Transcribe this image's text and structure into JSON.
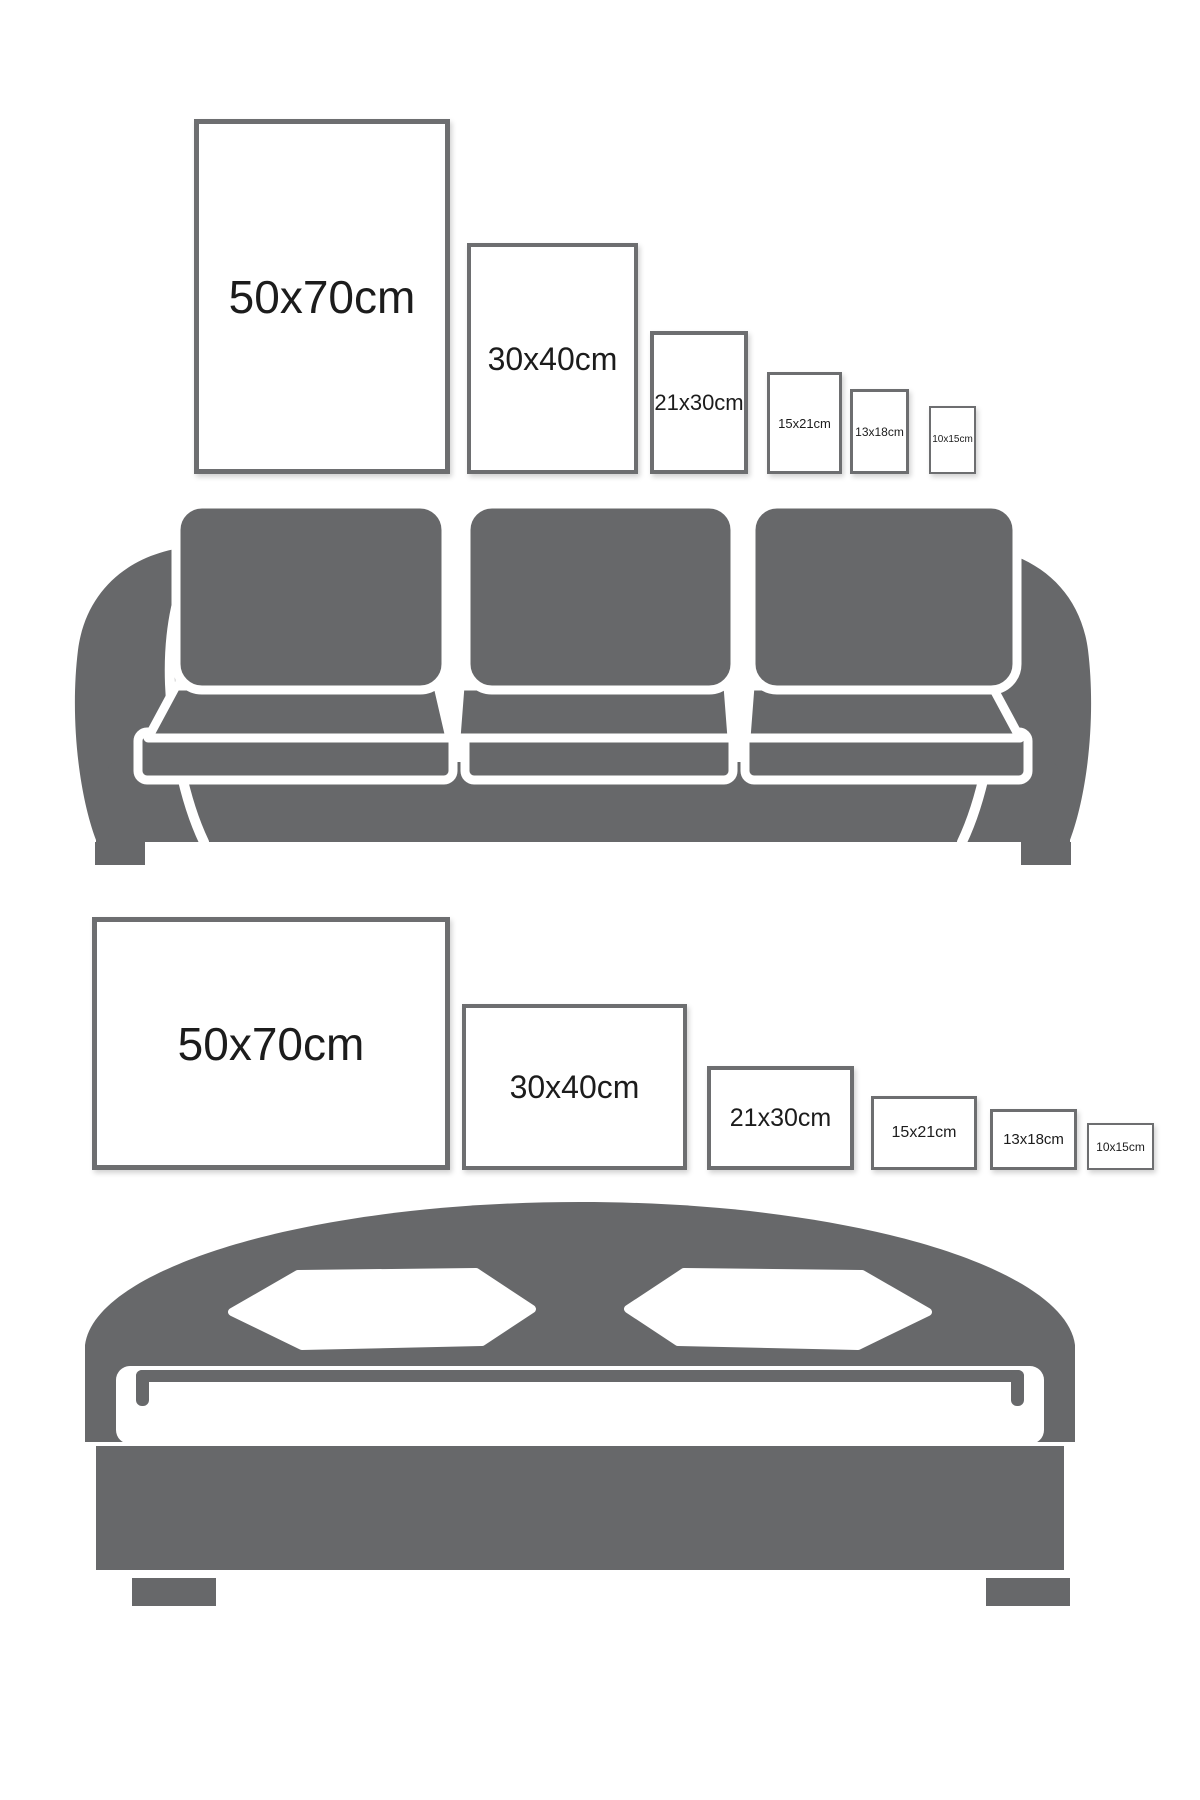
{
  "diagram": {
    "description": "Picture frame size guide comparing six frame sizes above a sofa (portrait orientation) and above a bed (landscape orientation)",
    "colors": {
      "background": "#ffffff",
      "furniture_gray": "#67686a",
      "frame_border": "#6d6e70",
      "label_text": "#1c1c1c"
    },
    "sections": [
      {
        "id": "sofa-wall",
        "furniture_icon": "sofa-icon",
        "frame_orientation": "portrait",
        "frames": [
          {
            "label": "50x70cm"
          },
          {
            "label": "30x40cm"
          },
          {
            "label": "21x30cm"
          },
          {
            "label": "15x21cm"
          },
          {
            "label": "13x18cm"
          },
          {
            "label": "10x15cm"
          }
        ]
      },
      {
        "id": "bed-wall",
        "furniture_icon": "bed-icon",
        "frame_orientation": "landscape",
        "frames": [
          {
            "label": "50x70cm"
          },
          {
            "label": "30x40cm"
          },
          {
            "label": "21x30cm"
          },
          {
            "label": "15x21cm"
          },
          {
            "label": "13x18cm"
          },
          {
            "label": "10x15cm"
          }
        ]
      }
    ]
  }
}
